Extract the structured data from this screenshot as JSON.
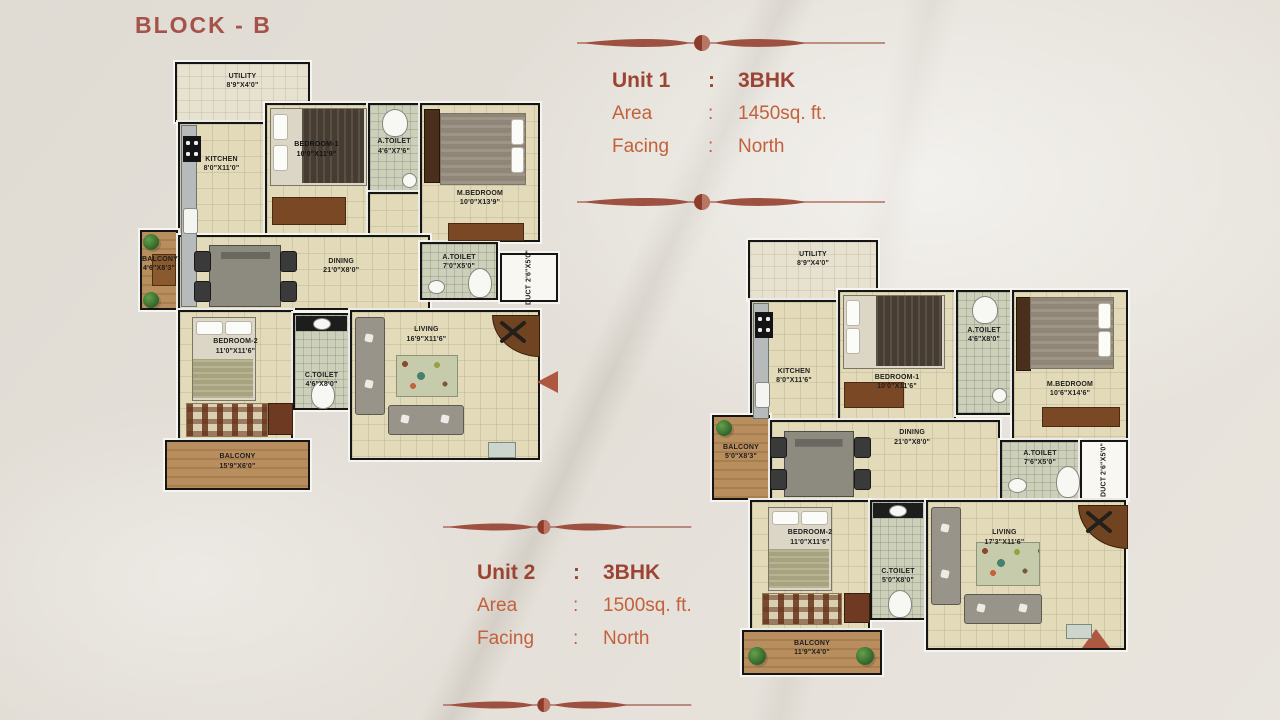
{
  "page": {
    "block_title": "BLOCK - B"
  },
  "unit1": {
    "title_label": "Unit 1",
    "sep": ":",
    "title_value": "3BHK",
    "area_label": "Area",
    "area_value": "1450sq. ft.",
    "facing_label": "Facing",
    "facing_value": "North"
  },
  "unit2": {
    "title_label": "Unit 2",
    "sep": ":",
    "title_value": "3BHK",
    "area_label": "Area",
    "area_value": "1500sq. ft.",
    "facing_label": "Facing",
    "facing_value": "North"
  },
  "plan1": {
    "rooms": {
      "utility": {
        "name": "UTILITY",
        "dims": "8'9\"X4'0\""
      },
      "kitchen": {
        "name": "KITCHEN",
        "dims": "8'0\"X11'0\""
      },
      "bedroom1": {
        "name": "BEDROOM-1",
        "dims": "10'0\"X11'9\""
      },
      "atoilet1": {
        "name": "A.TOILET",
        "dims": "4'6\"X7'6\""
      },
      "mbedroom": {
        "name": "M.BEDROOM",
        "dims": "10'0\"X13'9\""
      },
      "balcony_left": {
        "name": "BALCONY",
        "dims": "4'6\"X8'3\""
      },
      "dining": {
        "name": "DINING",
        "dims": "21'0\"X8'0\""
      },
      "atoilet2": {
        "name": "A.TOILET",
        "dims": "7'0\"X5'0\""
      },
      "duct": {
        "name": "DUCT",
        "dims": "2'6\"X5'0\""
      },
      "bedroom2": {
        "name": "BEDROOM-2",
        "dims": "11'0\"X11'6\""
      },
      "ctoilet": {
        "name": "C.TOILET",
        "dims": "4'6\"X8'0\""
      },
      "living": {
        "name": "LIVING",
        "dims": "16'9\"X11'6\""
      },
      "balcony_bottom": {
        "name": "BALCONY",
        "dims": "15'9\"X6'0\""
      }
    }
  },
  "plan2": {
    "rooms": {
      "utility": {
        "name": "UTILITY",
        "dims": "8'9\"X4'0\""
      },
      "kitchen": {
        "name": "KITCHEN",
        "dims": "8'0\"X11'6\""
      },
      "bedroom1": {
        "name": "BEDROOM-1",
        "dims": "10'0\"X11'6\""
      },
      "atoilet1": {
        "name": "A.TOILET",
        "dims": "4'6\"X8'0\""
      },
      "mbedroom": {
        "name": "M.BEDROOM",
        "dims": "10'6\"X14'6\""
      },
      "balcony_left": {
        "name": "BALCONY",
        "dims": "5'0\"X8'3\""
      },
      "dining": {
        "name": "DINING",
        "dims": "21'0\"X8'0\""
      },
      "atoilet2": {
        "name": "A.TOILET",
        "dims": "7'6\"X5'0\""
      },
      "duct": {
        "name": "DUCT",
        "dims": "2'6\"X5'0\""
      },
      "bedroom2": {
        "name": "BEDROOM-2",
        "dims": "11'0\"X11'6\""
      },
      "ctoilet": {
        "name": "C.TOILET",
        "dims": "5'0\"X8'0\""
      },
      "living": {
        "name": "LIVING",
        "dims": "17'3\"X11'6\""
      },
      "balcony_bottom": {
        "name": "BALCONY",
        "dims": "11'9\"X4'0\""
      }
    }
  }
}
